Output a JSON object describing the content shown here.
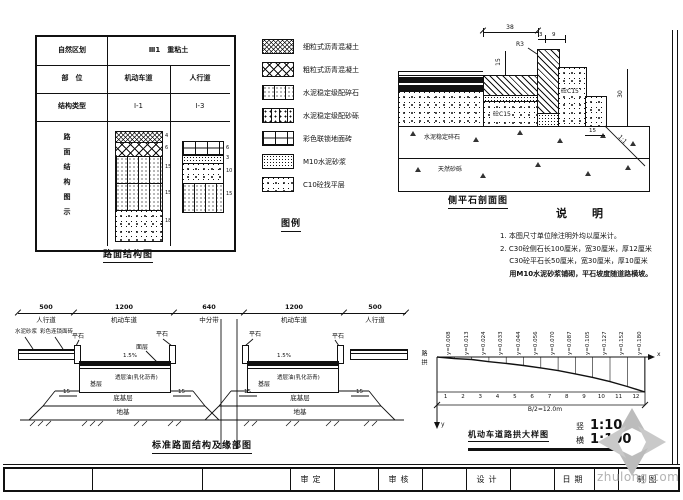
{
  "sheet": {
    "watermark_text": "zhulong.com"
  },
  "structure_table": {
    "row1_label": "自然区划",
    "row1_value": "Ⅲ1　重粘土",
    "row2_label": "部　位",
    "row2_col1": "机动车道",
    "row2_col2": "人行道",
    "row3_label": "结构类型",
    "row3_col1": "Ⅰ-1",
    "row3_col2": "Ⅰ-3",
    "row4_label": "路面结构图示",
    "motor_layers": [
      {
        "pattern": "fine-crosshatch",
        "thickness": "4",
        "px": 10
      },
      {
        "pattern": "coarse-crosshatch",
        "thickness": "6",
        "px": 13
      },
      {
        "pattern": "speckle-columns",
        "thickness": "15",
        "px": 26
      },
      {
        "pattern": "speckle-columns",
        "thickness": "15",
        "px": 26
      },
      {
        "pattern": "coarse-stipple",
        "thickness": "18",
        "px": 30
      }
    ],
    "sidewalk_layers": [
      {
        "pattern": "brick",
        "thickness": "6",
        "px": 13
      },
      {
        "pattern": "fine-stipple",
        "thickness": "3",
        "px": 7
      },
      {
        "pattern": "coarse-stipple",
        "thickness": "10",
        "px": 19
      },
      {
        "pattern": "speckle-columns",
        "thickness": "15",
        "px": 28
      }
    ],
    "caption": "路面结构图"
  },
  "legend": {
    "caption": "图例",
    "items": [
      {
        "pattern": "fine-crosshatch",
        "label": "细粒式沥青混凝土"
      },
      {
        "pattern": "coarse-crosshatch",
        "label": "粗粒式沥青混凝土"
      },
      {
        "pattern": "speckle-columns",
        "label": "水泥稳定级配碎石"
      },
      {
        "pattern": "speckle-blocks",
        "label": "水泥稳定级配砂砾"
      },
      {
        "pattern": "brick",
        "label": "彩色联锁地面砖"
      },
      {
        "pattern": "fine-stipple",
        "label": "M10水泥砂浆"
      },
      {
        "pattern": "coarse-stipple",
        "label": "C10砼找平层"
      }
    ]
  },
  "curb_detail": {
    "caption": "侧平石剖面图",
    "dims": {
      "top": "38",
      "a": "3",
      "b": "9",
      "radius": "R3",
      "left": "15",
      "right": "30",
      "step": "15",
      "slope": "1:1"
    },
    "labels": {
      "concrete_upper": "砼C15",
      "concrete_lower": "砼C15",
      "base": "水泥稳定碎石",
      "subbase": "天然砂砾"
    }
  },
  "notes": {
    "title": "说　明",
    "lines": [
      "1. 本图尺寸单位除注明外均以厘米计。",
      "2. C30砼侧石长100厘米，宽30厘米，厚12厘米",
      "　 C30砼平石长50厘米，宽30厘米，厚10厘米",
      "　 用M10水泥砂浆铺砌，平石坡度随道路横坡。"
    ]
  },
  "cross_section": {
    "caption": "标准路面结构及缘部图",
    "segments": [
      {
        "width": "500",
        "zone": "人行道",
        "px": 56
      },
      {
        "width": "1200",
        "zone": "机动车道",
        "px": 100
      },
      {
        "width": "640",
        "zone": "中分带",
        "px": 70
      },
      {
        "width": "1200",
        "zone": "机动车道",
        "px": 100
      },
      {
        "width": "500",
        "zone": "人行道",
        "px": 62
      }
    ],
    "labels": {
      "mortar": "水泥砂浆",
      "brick": "彩色连锁面砖",
      "flat_stone": "平石",
      "surface": "面层",
      "prime_coat": "透层油(乳化沥青)",
      "base": "基层",
      "subbase": "底基层",
      "subgrade": "地基",
      "slope": "1.5%",
      "edge_dim": "15"
    }
  },
  "crown_diagram": {
    "caption": "机动车道路拱大样图",
    "scale_v_label": "竖",
    "scale_v": "1:10",
    "scale_h_label": "横",
    "scale_h": "1:100",
    "axis_x": "x",
    "axis_y": "y",
    "side_label": "路拱",
    "bottom_dim": "B/2=12.0m",
    "chart": {
      "type": "line",
      "x": [
        1,
        2,
        3,
        4,
        5,
        6,
        7,
        8,
        9,
        10,
        11,
        12
      ],
      "y": [
        0.008,
        0.013,
        0.024,
        0.033,
        0.044,
        0.056,
        0.07,
        0.087,
        0.105,
        0.127,
        0.152,
        0.18
      ],
      "point_labels": [
        "y=0.008",
        "y=0.013",
        "y=0.024",
        "y=0.033",
        "y=0.044",
        "y=0.056",
        "y=0.070",
        "y=0.087",
        "y=0.105",
        "y=0.127",
        "y=0.152",
        "y=0.180"
      ]
    }
  },
  "title_block": {
    "cells": [
      "",
      "",
      "",
      "审定",
      "",
      "审核",
      "",
      "设计",
      "",
      "日期",
      "",
      "制图"
    ]
  }
}
